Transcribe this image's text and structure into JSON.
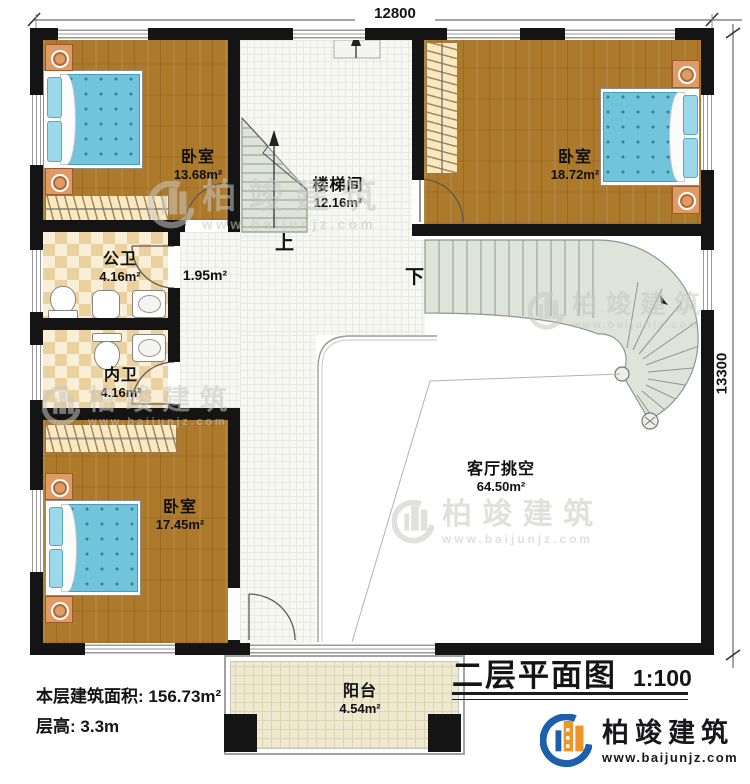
{
  "dimensions": {
    "top": "12800",
    "right": "13300"
  },
  "rooms": [
    {
      "id": "bedroom-top-left",
      "name": "卧室",
      "area": "13.68m²"
    },
    {
      "id": "stairwell",
      "name": "楼梯间",
      "area": "12.16m²"
    },
    {
      "id": "bedroom-right",
      "name": "卧室",
      "area": "18.72m²"
    },
    {
      "id": "public-bath",
      "name": "公卫",
      "area": "4.16m²"
    },
    {
      "id": "hallway",
      "name": "",
      "area": "1.95m²"
    },
    {
      "id": "private-bath",
      "name": "内卫",
      "area": "4.16m²"
    },
    {
      "id": "bedroom-bottom-left",
      "name": "卧室",
      "area": "17.45m²"
    },
    {
      "id": "living-void",
      "name": "客厅挑空",
      "area": "64.50m²"
    },
    {
      "id": "balcony",
      "name": "阳台",
      "area": "4.54m²"
    }
  ],
  "stairs": {
    "up_label": "上",
    "down_label": "下"
  },
  "footer": {
    "floor_area_label": "本层建筑面积:",
    "floor_area_value": "156.73m²",
    "floor_height_label": "层高:",
    "floor_height_value": "3.3m",
    "title": "二层平面图",
    "scale": "1:100"
  },
  "brand": {
    "name": "柏竣建筑",
    "website": "www.baijunjz.com"
  },
  "colors": {
    "wall": "#141414",
    "wood": "#ad7a2c",
    "stair": "#dfe4da",
    "brand_blue": "#1b5fae",
    "brand_orange": "#f09428"
  }
}
